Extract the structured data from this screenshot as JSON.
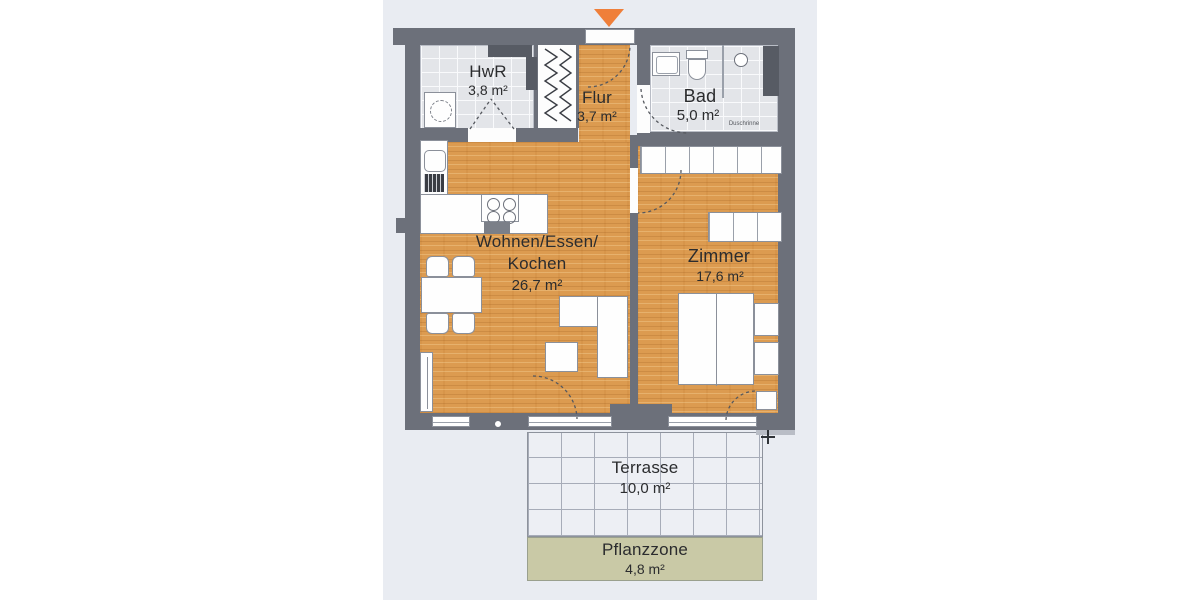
{
  "rooms": {
    "hwr": {
      "name": "HwR",
      "area": "3,8 m²"
    },
    "flur": {
      "name": "Flur",
      "area": "3,7 m²"
    },
    "bad": {
      "name": "Bad",
      "area": "5,0 m²"
    },
    "wohnen": {
      "name_line1": "Wohnen/Essen/",
      "name_line2": "Kochen",
      "area": "26,7 m²"
    },
    "zimmer": {
      "name": "Zimmer",
      "area": "17,6 m²"
    },
    "terrasse": {
      "name": "Terrasse",
      "area": "10,0 m²"
    },
    "pflanzzone": {
      "name": "Pflanzzone",
      "area": "4,8 m²"
    }
  },
  "annotations": {
    "shower_drain": "Duschrinne"
  },
  "colors": {
    "page": "#ffffff",
    "background_band": "#e9ecf2",
    "wall": "#6c707a",
    "wood": "#dc9b50",
    "tile_floor": "#e3e5e9",
    "terrace_tile": "#edeff4",
    "terrace_joint": "#a7acb8",
    "plant_zone": "#c9c9a6",
    "entrance_marker": "#ef7f3a",
    "furniture_outline": "#8b909a"
  }
}
